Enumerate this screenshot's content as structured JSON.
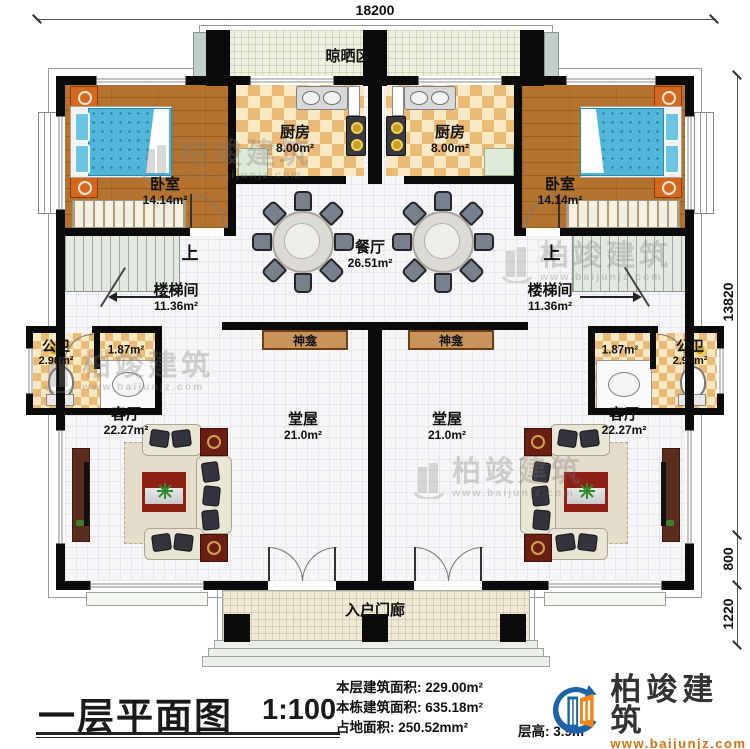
{
  "dimensions": {
    "top_width": "18200",
    "right_height": "13820",
    "right_step": "800",
    "right_porch": "1220"
  },
  "rooms": {
    "drying_area": {
      "name": "晾晒区"
    },
    "bedroom_left": {
      "name": "卧室",
      "area": "14.14m²"
    },
    "bedroom_right": {
      "name": "卧室",
      "area": "14.14m²"
    },
    "kitchen_left": {
      "name": "厨房",
      "area": "8.00m²"
    },
    "kitchen_right": {
      "name": "厨房",
      "area": "8.00m²"
    },
    "dining": {
      "name": "餐厅",
      "area": "26.51m²"
    },
    "stair_left": {
      "name": "楼梯间",
      "area": "11.36m²",
      "up": "上"
    },
    "stair_right": {
      "name": "楼梯间",
      "area": "11.36m²",
      "up": "上"
    },
    "bath_left": {
      "name": "公卫",
      "area": "2.90m²",
      "basin_area": "1.87m²"
    },
    "bath_right": {
      "name": "公卫",
      "area": "2.90m²",
      "basin_area": "1.87m²"
    },
    "shrine_left": {
      "name": "神龛"
    },
    "shrine_right": {
      "name": "神龛"
    },
    "hall_left": {
      "name": "堂屋",
      "area": "21.0m²"
    },
    "hall_right": {
      "name": "堂屋",
      "area": "21.0m²"
    },
    "living_left": {
      "name": "客厅",
      "area": "22.27m²"
    },
    "living_right": {
      "name": "客厅",
      "area": "22.27m²"
    },
    "porch": {
      "name": "入户门廊"
    }
  },
  "title_block": {
    "title": "一层平面图",
    "scale": "1:100",
    "stats": [
      {
        "label": "本层建筑面积:",
        "value": "229.00m²"
      },
      {
        "label": "本栋建筑面积:",
        "value": "635.18m²"
      },
      {
        "label": "占地面积:",
        "value": "250.52mm²"
      },
      {
        "label": "层高:",
        "value": "3.9m"
      }
    ]
  },
  "brand": {
    "name": "柏竣建筑",
    "url": "www.baijunjz.com"
  },
  "watermark": {
    "name": "柏竣建筑",
    "url": "www.baijunjz.com"
  },
  "colors": {
    "wall": "#0b0b0b",
    "brand_blue": "#1c63a8",
    "brand_orange": "#ef8418",
    "tile": "#eaba77",
    "wood": "#b3732e"
  }
}
